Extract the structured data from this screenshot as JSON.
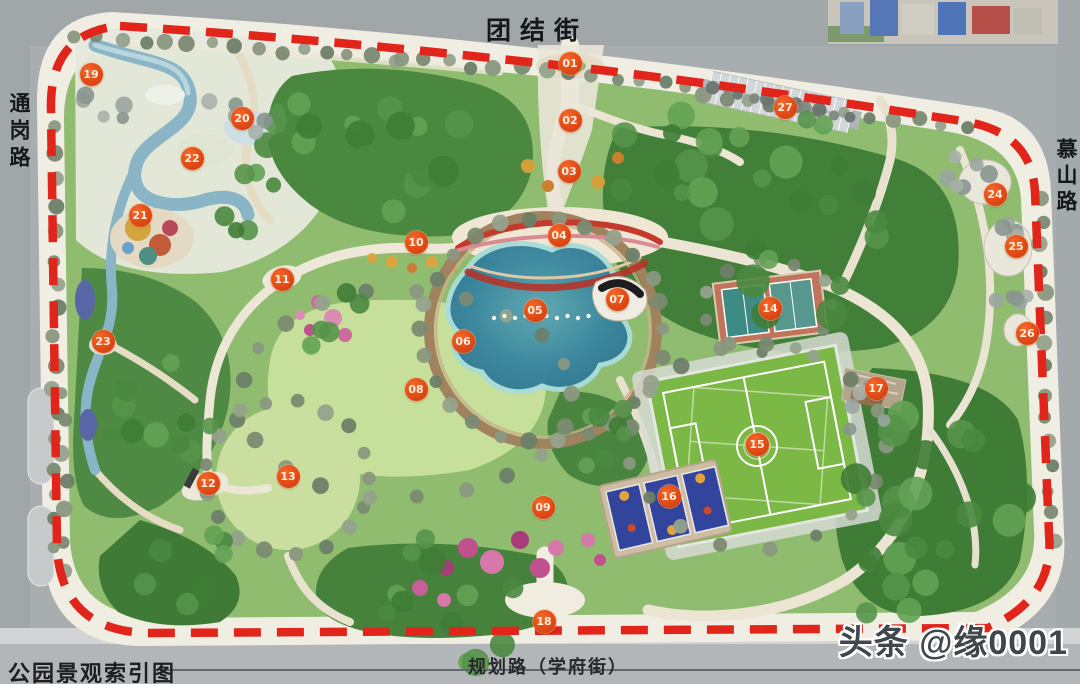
{
  "title": "公园景观索引图",
  "streets": {
    "top": "团结街",
    "left": "通岗路",
    "right": "慕山路",
    "bottom": "规划路（学府街）"
  },
  "watermark": {
    "brand": "头条",
    "handle": "@缘0001"
  },
  "boundary": {
    "color": "#e1251b",
    "style": "dashed"
  },
  "marker_style": {
    "fill": "#e14a16",
    "text_color": "#ffeede"
  },
  "markers": [
    {
      "id": "01",
      "x": 570,
      "y": 63
    },
    {
      "id": "02",
      "x": 570,
      "y": 120
    },
    {
      "id": "03",
      "x": 569,
      "y": 171
    },
    {
      "id": "04",
      "x": 559,
      "y": 235
    },
    {
      "id": "05",
      "x": 535,
      "y": 310
    },
    {
      "id": "06",
      "x": 463,
      "y": 341
    },
    {
      "id": "07",
      "x": 617,
      "y": 299
    },
    {
      "id": "08",
      "x": 416,
      "y": 389
    },
    {
      "id": "09",
      "x": 543,
      "y": 507
    },
    {
      "id": "10",
      "x": 416,
      "y": 242
    },
    {
      "id": "11",
      "x": 282,
      "y": 279
    },
    {
      "id": "12",
      "x": 208,
      "y": 483
    },
    {
      "id": "13",
      "x": 288,
      "y": 476
    },
    {
      "id": "14",
      "x": 770,
      "y": 308
    },
    {
      "id": "15",
      "x": 757,
      "y": 444
    },
    {
      "id": "16",
      "x": 669,
      "y": 496
    },
    {
      "id": "17",
      "x": 876,
      "y": 388
    },
    {
      "id": "18",
      "x": 544,
      "y": 621
    },
    {
      "id": "19",
      "x": 91,
      "y": 74
    },
    {
      "id": "20",
      "x": 242,
      "y": 118
    },
    {
      "id": "21",
      "x": 140,
      "y": 215
    },
    {
      "id": "22",
      "x": 192,
      "y": 158
    },
    {
      "id": "23",
      "x": 103,
      "y": 341
    },
    {
      "id": "24",
      "x": 995,
      "y": 194
    },
    {
      "id": "25",
      "x": 1016,
      "y": 246
    },
    {
      "id": "26",
      "x": 1027,
      "y": 333
    },
    {
      "id": "27",
      "x": 785,
      "y": 107
    }
  ]
}
